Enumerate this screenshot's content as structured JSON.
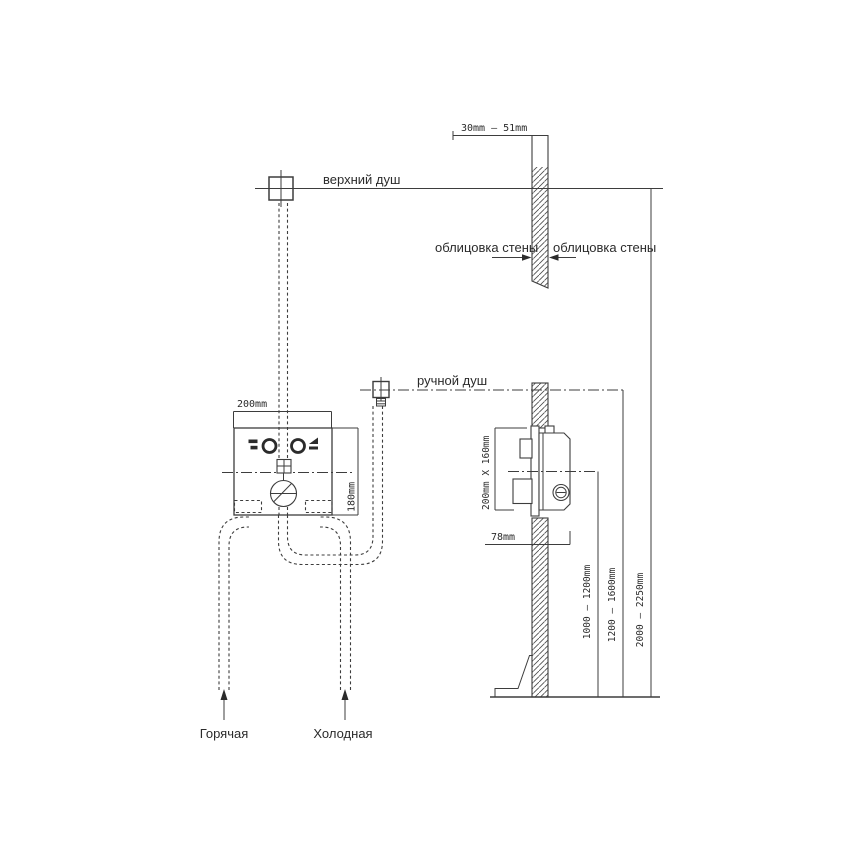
{
  "labels": {
    "top_shower": "верхний душ",
    "hand_shower": "ручной душ",
    "wall_cladding_left": "облицовка стены",
    "wall_cladding_right": "облицовка стены",
    "hot_supply": "Горячая",
    "cold_supply": "Холодная"
  },
  "dimensions": {
    "wall_thickness": "30mm  –  51mm",
    "box_width": "200mm",
    "box_height": "180mm",
    "rough_in": "200mm X 160mm",
    "mount_depth": "78mm",
    "mixer_height_range": "1000 – 1200mm",
    "hand_shower_height_range": "1200 – 1600mm",
    "top_shower_height_range": "2000 – 2250mm"
  },
  "colors": {
    "line": "#3d3d3d",
    "text": "#2b2b2b",
    "background": "#ffffff"
  }
}
